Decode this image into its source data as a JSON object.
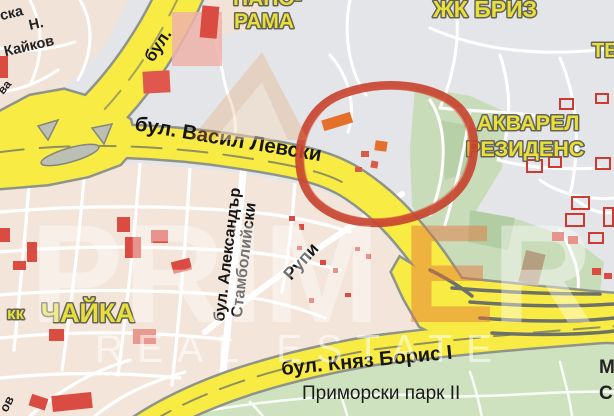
{
  "labels": {
    "vasil_levski": "бул. Васил Левски",
    "knyaz_boris": "бул. Княз Борис I",
    "bul_partial": "бул.",
    "aleksandar_1": "бул. Александър",
    "aleksandar_2": "Стамболийски",
    "rupi": "Рупи",
    "primorski_park": "Приморски парк II",
    "panorama_1": "ПАНО-",
    "panorama_2": "РАМА",
    "zhk_briz": "ЖК БРИЗ",
    "te_partial": "ТЕ",
    "akvarel_1": "АКВАРЕЛ",
    "akvarel_2": "РЕЗИДЕНС",
    "kk": "кк",
    "chayka": "ЧАЙКА",
    "ska": "ска",
    "n_initial": "Н.",
    "kaykov": "Кайков",
    "va_partial": "ва",
    "ov_partial": "ов",
    "m_partial": "М",
    "s_partial": "С"
  },
  "watermark": {
    "brand_part1": "PRIM",
    "brand_accent": "E",
    "brand_part2": "R",
    "subtitle": "REAL ESTATE"
  },
  "colors": {
    "road_yellow": "#f8ec44",
    "road_casing": "#8f948a",
    "urban_pink": "#f4e5da",
    "urban_gray": "#e3e5e8",
    "park_green": "#cce0bd",
    "building_red": "#da4b42",
    "label_yellow": "#e9df3a",
    "annotation_red": "#c7402e"
  }
}
